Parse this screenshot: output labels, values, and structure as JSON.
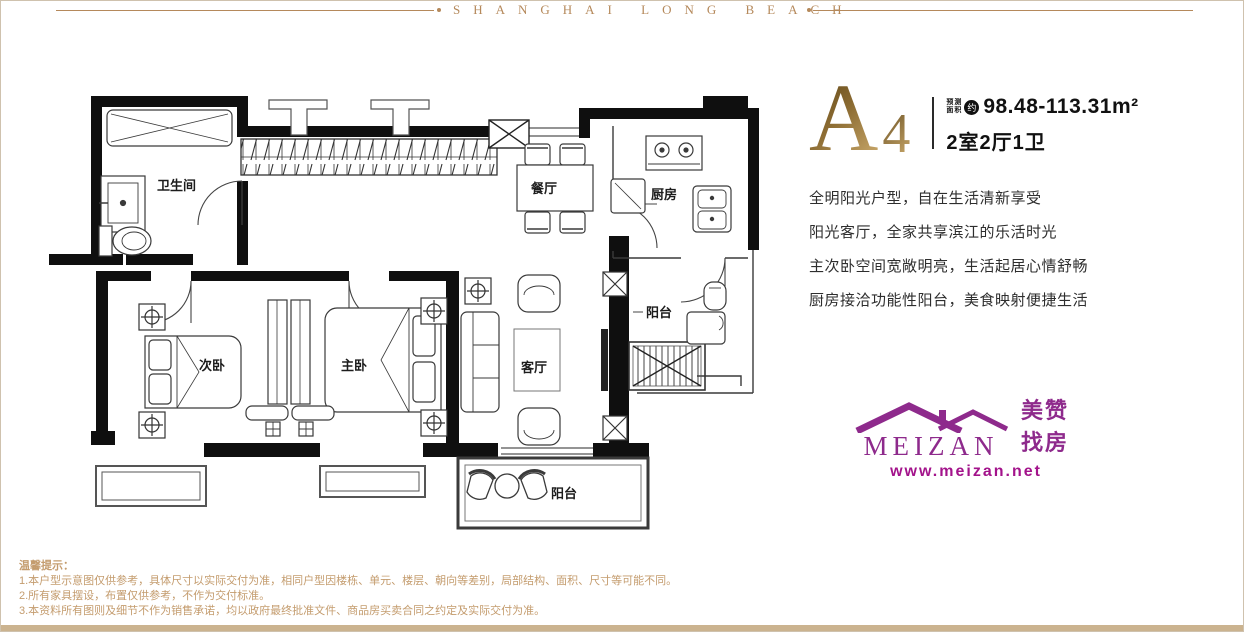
{
  "brand": {
    "header_text": "SHANGHAI LONG BEACH"
  },
  "unit": {
    "letter": "A",
    "number": "4",
    "area_label_line1": "预测",
    "area_label_line2": "面积",
    "area_approx_badge": "约",
    "area_value": "98.48-113.31m²",
    "layout_text": "2室2厅1卫"
  },
  "descriptions": [
    "全明阳光户型，自在生活清新享受",
    "阳光客厅，全家共享滨江的乐活时光",
    "主次卧空间宽敞明亮，生活起居心情舒畅",
    "厨房接洽功能性阳台，美食映射便捷生活"
  ],
  "floorplan": {
    "rooms": {
      "bathroom": "卫生间",
      "dining": "餐厅",
      "kitchen": "厨房",
      "service_balcony": "阳台",
      "secondary_bedroom": "次卧",
      "master_bedroom": "主卧",
      "living_room": "客厅",
      "south_balcony": "阳台"
    }
  },
  "logo": {
    "name": "MEIZAN",
    "tagline": "美赞找房",
    "website": "www.meizan.net"
  },
  "notes": {
    "title": "温馨提示：",
    "items": [
      "1.本户型示意图仅供参考，具体尺寸以实际交付为准，相同户型因楼栋、单元、楼层、朝向等差别，局部结构、面积、尺寸等可能不同。",
      "2.所有家具摆设，布置仅供参考，不作为交付标准。",
      "3.本资料所有图则及细节不作为销售承诺，均以政府最终批准文件、商品房买卖合同之约定及实际交付为准。"
    ]
  },
  "colors": {
    "gold": "#b5895b",
    "gold_dark": "#6a5124",
    "gold_light": "#c9a86a",
    "purple": "#8e2a8c",
    "url_purple": "#a3138b",
    "note_tan": "#c49c6e",
    "bottom_bar": "#cbb38f"
  }
}
